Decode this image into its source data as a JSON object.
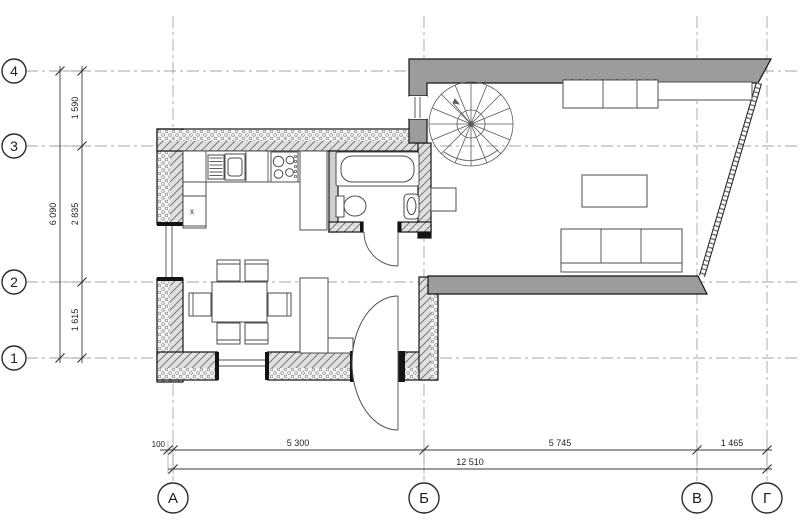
{
  "axes": {
    "rows": [
      "4",
      "3",
      "2",
      "1"
    ],
    "cols": [
      "А",
      "Б",
      "В",
      "Г"
    ]
  },
  "dims": {
    "v_total": "6 090",
    "v_seg_top": "1 590",
    "v_seg_mid": "2 835",
    "v_seg_bot": "1 615",
    "h_offset": "100",
    "h_seg_1": "5 300",
    "h_seg_2": "5 745",
    "h_seg_3": "1 465",
    "h_total": "12 510"
  },
  "marks": {
    "dishwasher": "x"
  },
  "colors": {
    "wall_gray": "#9c9c9c",
    "line": "#1f1f1f",
    "grid": "#a3a3a3"
  }
}
